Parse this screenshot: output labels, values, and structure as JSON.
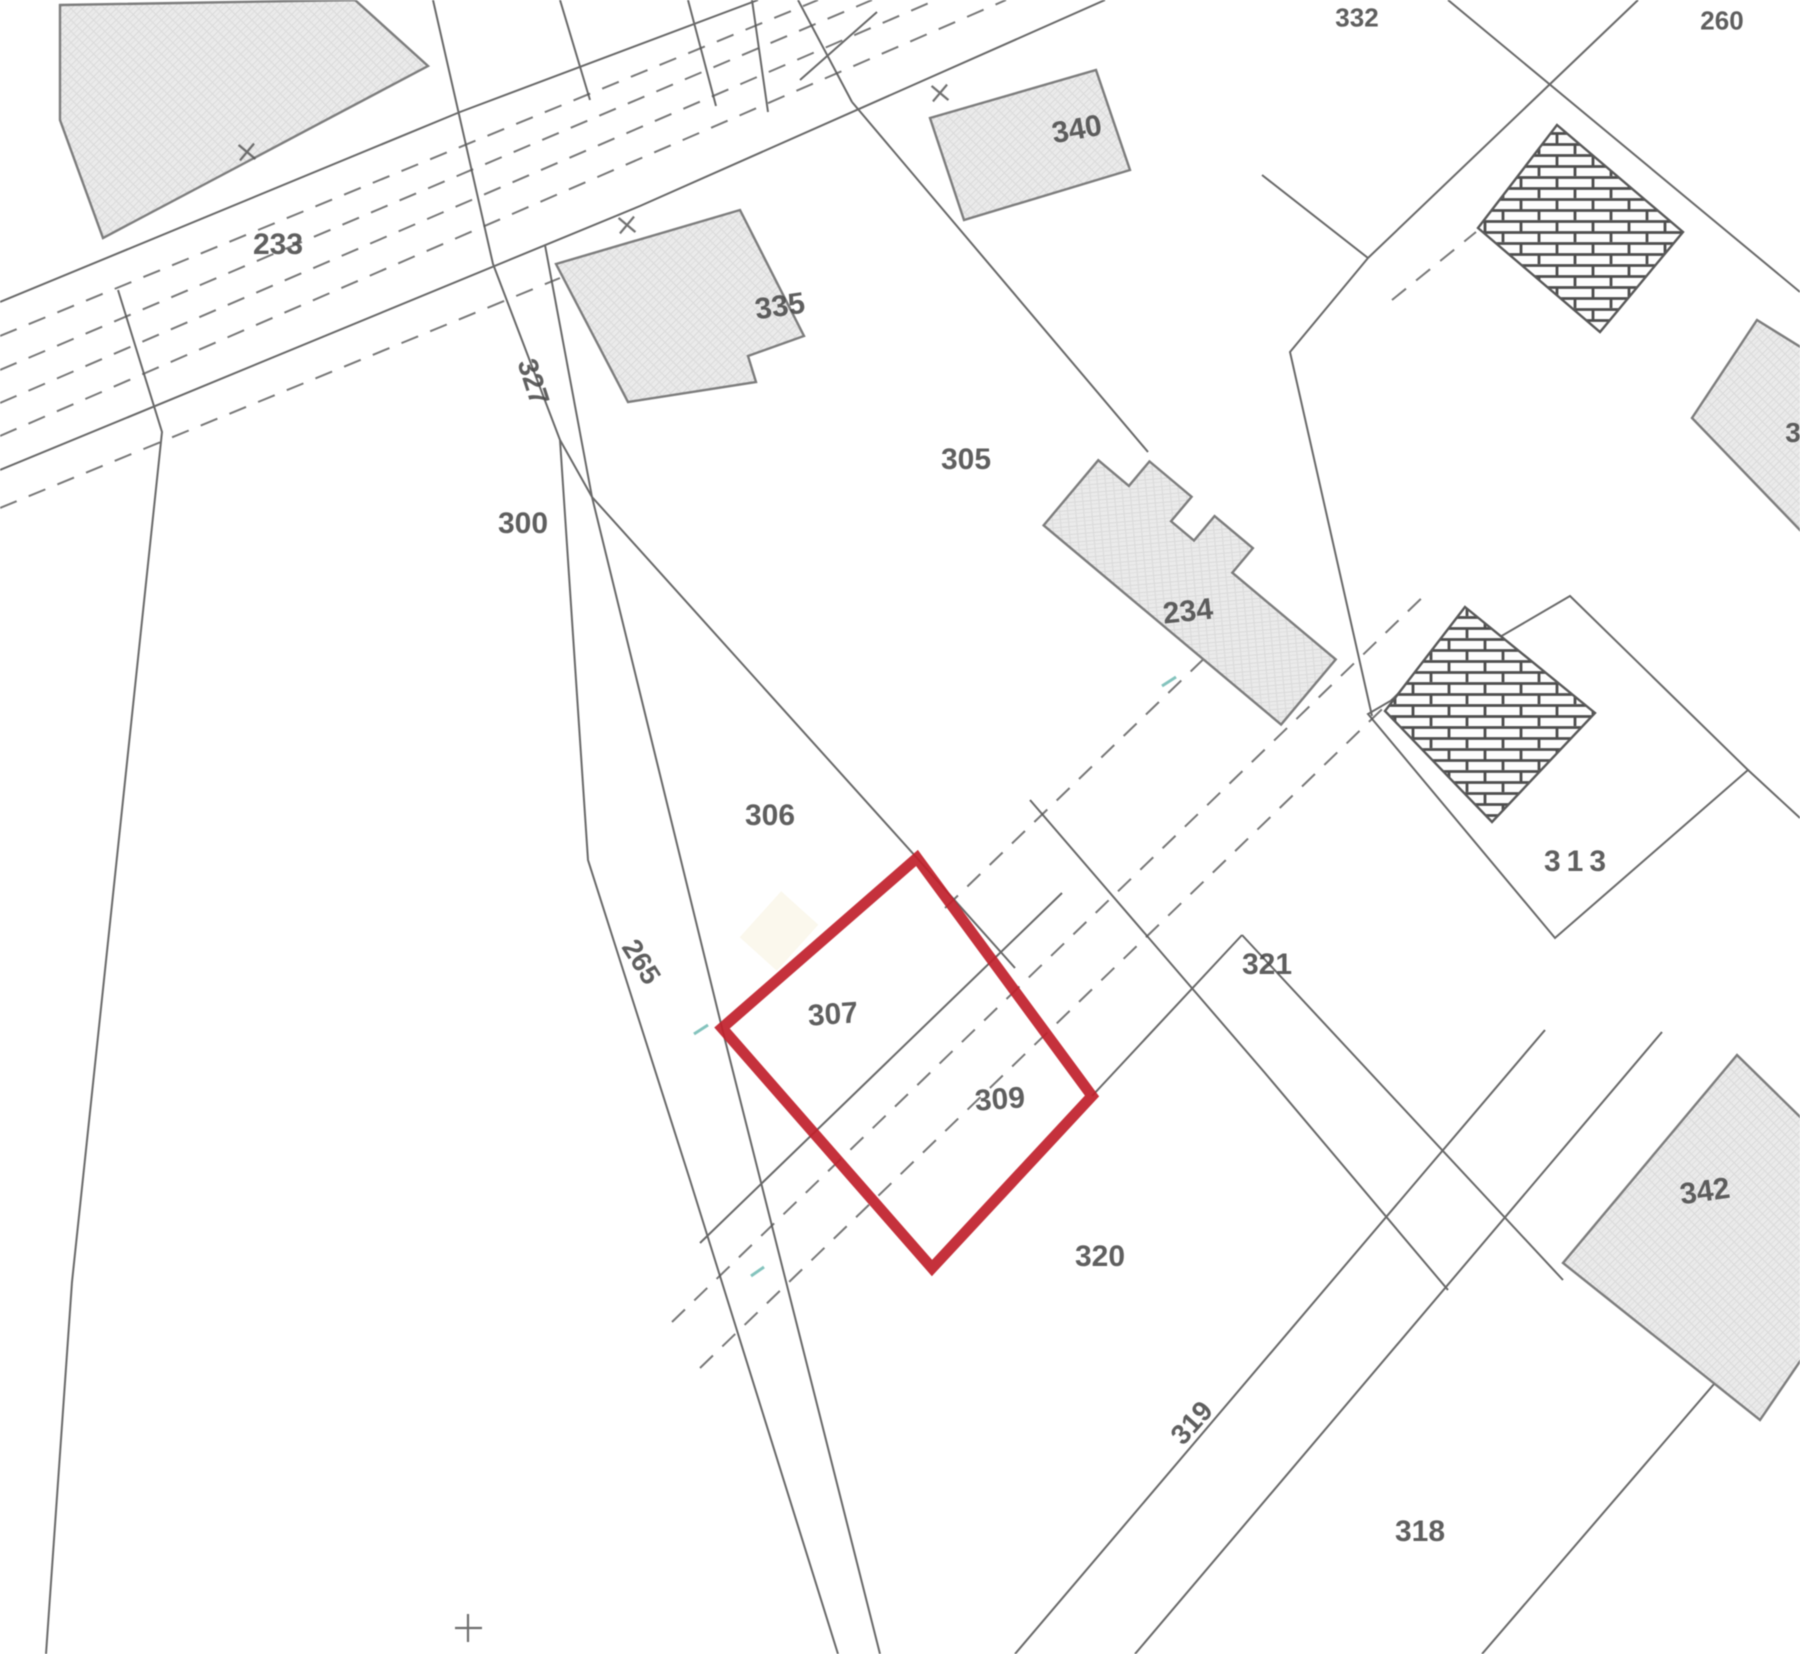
{
  "map": {
    "title": "cadastral-parcel-plan",
    "highlight_color": "#c0232e",
    "line_color": "#555555",
    "building_fill": "#e9e9e9",
    "highlighted_parcels": "307, 309",
    "labels": [
      {
        "text": "233",
        "x": 278,
        "y": 245,
        "rot": 0,
        "size": 30
      },
      {
        "text": "335",
        "x": 780,
        "y": 307,
        "rot": -8,
        "size": 30
      },
      {
        "text": "340",
        "x": 1077,
        "y": 130,
        "rot": -10,
        "size": 30
      },
      {
        "text": "332",
        "x": 1357,
        "y": 18,
        "rot": 0,
        "size": 26
      },
      {
        "text": "260",
        "x": 1722,
        "y": 21,
        "rot": 0,
        "size": 26
      },
      {
        "text": "327",
        "x": 533,
        "y": 382,
        "rot": 72,
        "size": 28
      },
      {
        "text": "300",
        "x": 523,
        "y": 524,
        "rot": 0,
        "size": 30
      },
      {
        "text": "305",
        "x": 966,
        "y": 460,
        "rot": 0,
        "size": 30
      },
      {
        "text": "234",
        "x": 1188,
        "y": 612,
        "rot": -6,
        "size": 30
      },
      {
        "text": "313",
        "x": 1578,
        "y": 862,
        "rot": 0,
        "size": 30,
        "ls": 6
      },
      {
        "text": "306",
        "x": 770,
        "y": 816,
        "rot": 0,
        "size": 30
      },
      {
        "text": "265",
        "x": 641,
        "y": 962,
        "rot": 58,
        "size": 28
      },
      {
        "text": "307",
        "x": 833,
        "y": 1015,
        "rot": -4,
        "size": 30
      },
      {
        "text": "309",
        "x": 1000,
        "y": 1100,
        "rot": -4,
        "size": 30
      },
      {
        "text": "321",
        "x": 1267,
        "y": 965,
        "rot": 0,
        "size": 30
      },
      {
        "text": "320",
        "x": 1100,
        "y": 1257,
        "rot": 0,
        "size": 30
      },
      {
        "text": "319",
        "x": 1192,
        "y": 1423,
        "rot": -48,
        "size": 28
      },
      {
        "text": "318",
        "x": 1420,
        "y": 1532,
        "rot": 0,
        "size": 30
      },
      {
        "text": "342",
        "x": 1705,
        "y": 1192,
        "rot": -8,
        "size": 30
      },
      {
        "text": "3",
        "x": 1793,
        "y": 433,
        "rot": 0,
        "size": 28
      }
    ]
  }
}
